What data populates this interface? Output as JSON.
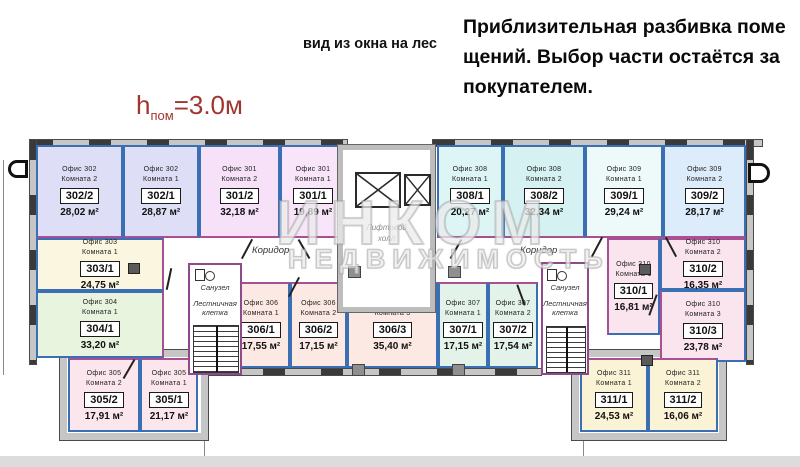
{
  "header": {
    "note_lines": [
      "Приблизительная разбивка поме",
      "щений. Выбор части остаётся за",
      "покупателем."
    ],
    "view_note": "вид из окна на лес",
    "height_prefix": "h",
    "height_sub": "пом",
    "height_value": "=3.0м"
  },
  "watermark": {
    "brand": "ИНКОМ",
    "subtitle": "НЕДВИЖИМОСТЬ"
  },
  "plan_labels": {
    "corridor_left": "Коридор",
    "corridor_right": "Коридор",
    "elevator_hall_line1": "Лифтовой",
    "elevator_hall_line2": "холл",
    "bathroom_left": "Санузел",
    "bathroom_right": "Санузел",
    "staircase_left_line1": "Лестничная",
    "staircase_left_line2": "клетка",
    "staircase_right_line1": "Лестничная",
    "staircase_right_line2": "клетка"
  },
  "colors": {
    "partition_blue": "#3b6fb4",
    "partition_magenta": "#a94f93",
    "wall_gray": "#c6c6c6",
    "height_note_red": "#a0362e"
  },
  "rooms": [
    {
      "office": "Офис 302",
      "room": "Комната 2",
      "number": "302/2",
      "area": "28,02 м²",
      "color": "#dedef6"
    },
    {
      "office": "Офис 302",
      "room": "Комната 1",
      "number": "302/1",
      "area": "28,87 м²",
      "color": "#dedef6"
    },
    {
      "office": "Офис 301",
      "room": "Комната 2",
      "number": "301/2",
      "area": "32,18 м²",
      "color": "#f6e1f8"
    },
    {
      "office": "Офис 301",
      "room": "Комната 1",
      "number": "301/1",
      "area": "19,89 м²",
      "color": "#f8e5f9"
    },
    {
      "office": "Офис 308",
      "room": "Комната 1",
      "number": "308/1",
      "area": "20,27 м²",
      "color": "#ddf5f5"
    },
    {
      "office": "Офис 308",
      "room": "Комната 2",
      "number": "308/2",
      "area": "32,34 м²",
      "color": "#d5f1f1"
    },
    {
      "office": "Офис 309",
      "room": "Комната 1",
      "number": "309/1",
      "area": "29,24 м²",
      "color": "#eefafa"
    },
    {
      "office": "Офис 309",
      "room": "Комната 2",
      "number": "309/2",
      "area": "28,17 м²",
      "color": "#dcecfa"
    },
    {
      "office": "Офис 303",
      "room": "Комната 1",
      "number": "303/1",
      "area": "24,75 м²",
      "color": "#fbf6df"
    },
    {
      "office": "Офис 304",
      "room": "Комната 1",
      "number": "304/1",
      "area": "33,20 м²",
      "color": "#e8f4de"
    },
    {
      "office": "Офис 305",
      "room": "Комната 2",
      "number": "305/2",
      "area": "17,91 м²",
      "color": "#fbe6ee"
    },
    {
      "office": "Офис 305",
      "room": "Комната 1",
      "number": "305/1",
      "area": "21,17 м²",
      "color": "#fbe6ee"
    },
    {
      "office": "Офис 306",
      "room": "Комната 1",
      "number": "306/1",
      "area": "17,55 м²",
      "color": "#fce9e3"
    },
    {
      "office": "Офис 306",
      "room": "Комната 2",
      "number": "306/2",
      "area": "17,15 м²",
      "color": "#fce9e3"
    },
    {
      "office": "Офис 306",
      "room": "Комната 3",
      "number": "306/3",
      "area": "35,40 м²",
      "color": "#fce9e3"
    },
    {
      "office": "Офис 307",
      "room": "Комната 1",
      "number": "307/1",
      "area": "17,15 м²",
      "color": "#e3f3e9"
    },
    {
      "office": "Офис 307",
      "room": "Комната 2",
      "number": "307/2",
      "area": "17,54 м²",
      "color": "#e3f3e9"
    },
    {
      "office": "Офис 310",
      "room": "Комната 2",
      "number": "310/2",
      "area": "16,35 м²",
      "color": "#fae4ee"
    },
    {
      "office": "Офис 310",
      "room": "Комната 1",
      "number": "310/1",
      "area": "16,81 м²",
      "color": "#fae4ee"
    },
    {
      "office": "Офис 310",
      "room": "Комната 3",
      "number": "310/3",
      "area": "23,78 м²",
      "color": "#fae4ee"
    },
    {
      "office": "Офис 311",
      "room": "Комната 1",
      "number": "311/1",
      "area": "24,53 м²",
      "color": "#fbf3d6"
    },
    {
      "office": "Офис 311",
      "room": "Комната 2",
      "number": "311/2",
      "area": "16,06 м²",
      "color": "#fbf3d6"
    }
  ]
}
